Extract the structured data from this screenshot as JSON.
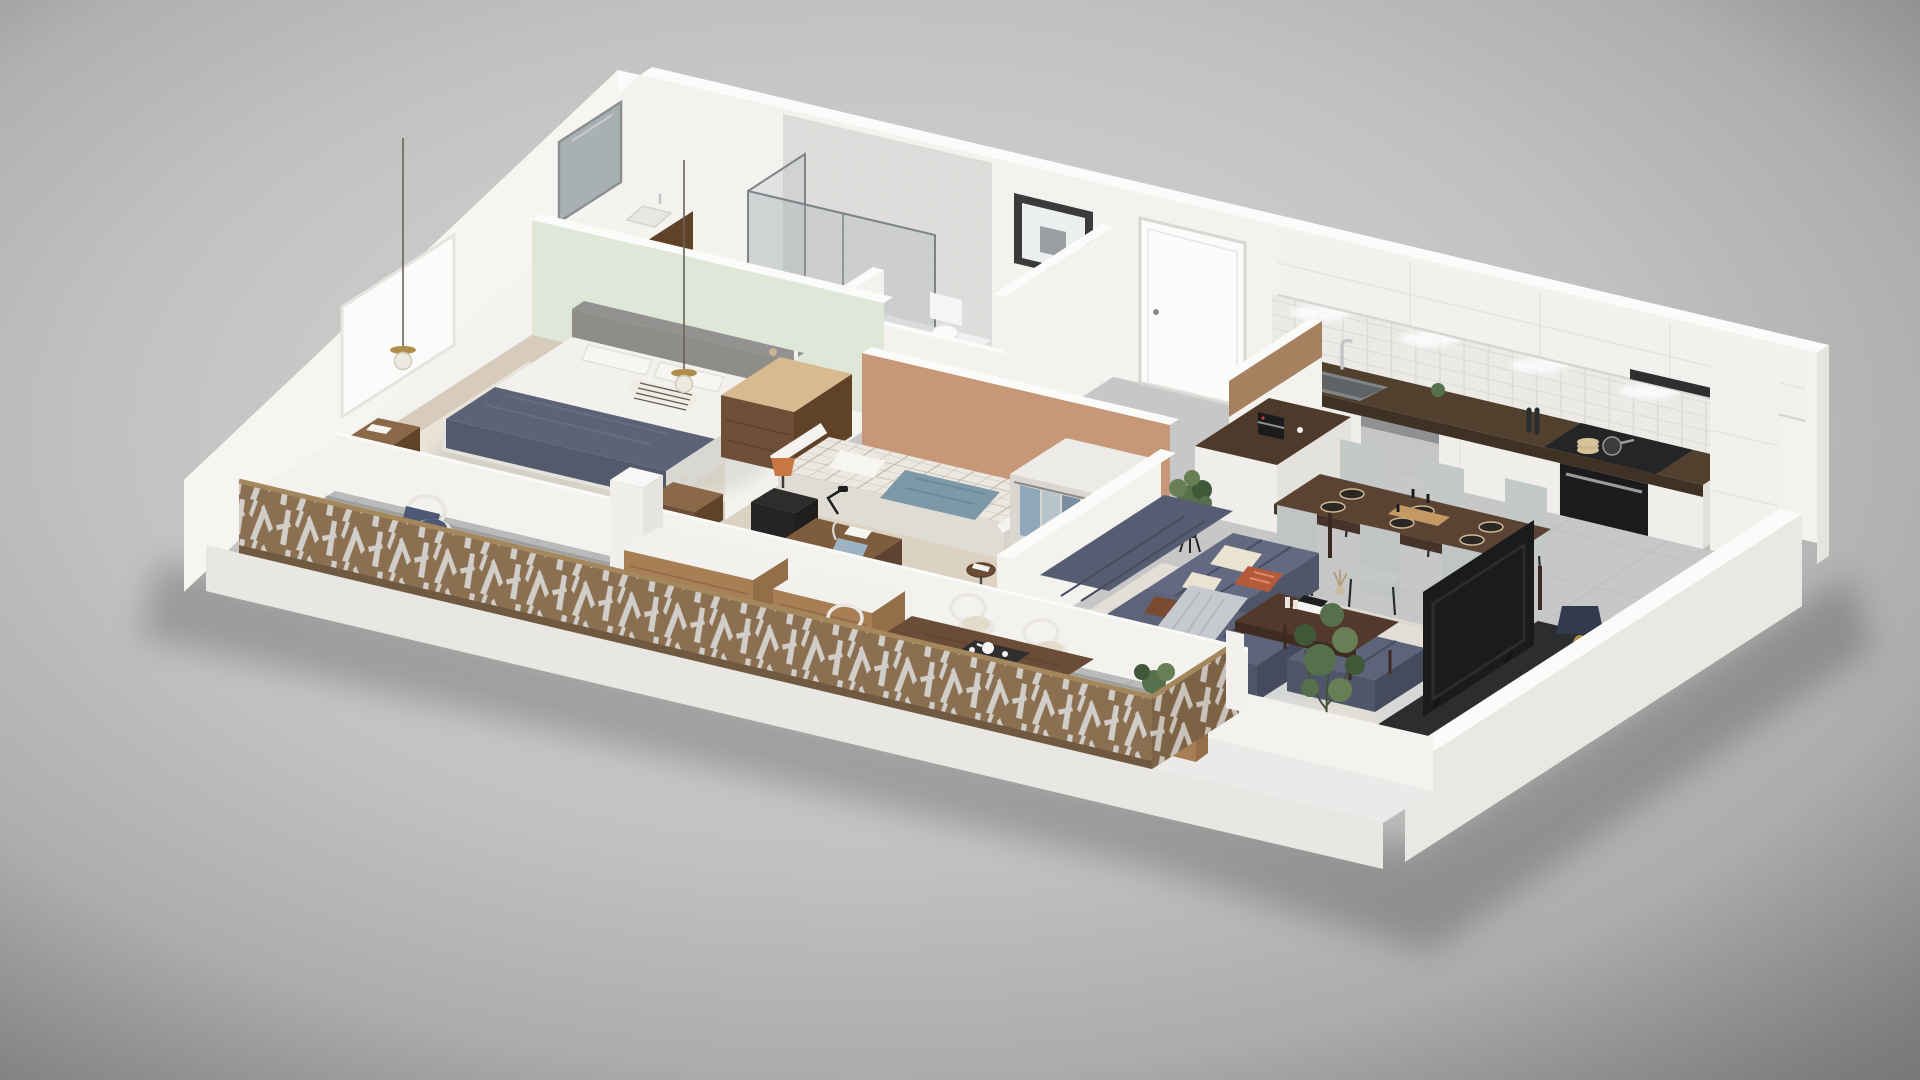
{
  "scene": {
    "title": "3D isometric cutaway floor plan of a furnished one-bedroom-plus apartment with balcony",
    "view": "aerial dollhouse cutaway, walls sliced low toward the viewer",
    "background": {
      "center": "#dadad9",
      "edge": "#989897"
    }
  },
  "palette": {
    "bg_center": "#dadad9",
    "bg_mid": "#c2c2c1",
    "bg_edge": "#989897",
    "wall_white": "#f3f2ef",
    "wall_top": "#fbfbf9",
    "wall_shade": "#e6e4e0",
    "wall_outer": "#f6f5f2",
    "wall_dark": "#d7d5d1",
    "slab_front": "#e9e7e3",
    "slab_right": "#d8d6d2",
    "ledge": "#eceae8",
    "green_wall": "#dfe7d8",
    "terracotta": "#c69878",
    "floor_gray": "#c6c7c6",
    "floor_line": "#b7b8b7",
    "floor_beige": "#d7ccbc",
    "rug_cream": "#eae4d8",
    "floor_b2": "#dcd2c2",
    "balcony_floor": "#b9bab9",
    "balcony_line": "#a7a8a7",
    "rug_living": "#e4dfd6",
    "rug_blotch_blue": "#cdd3d7",
    "rug_blotch_tan": "#d9cbbc",
    "counter_dark": "#52402f",
    "counter_edge": "#3f3124",
    "cabinet_face": "#efeeea",
    "cabinet_upper": "#f2f1ee",
    "backsplash": "#eceae7",
    "tile_line": "#dcdad6",
    "tile_wall": "#dedddb",
    "oven_black": "#1b1b1d",
    "steel": "#c3c5c6",
    "steel_dark": "#8e9092",
    "cooktop": "#242527",
    "island_top": "#4e3a2b",
    "table_wood": "#5b4334",
    "table_apron": "#46332a",
    "coffee_table": "#52392b",
    "wood_leg": "#3a2a22",
    "chair_gray": "#c3c9c7",
    "chair_gray_dark": "#bfc5c3",
    "chair_leg": "#2c2c2c",
    "plate_dark": "#2b2724",
    "plate_ring": "#cfb995",
    "runner_board": "#c49a62",
    "sofa": "#565d72",
    "sofa_seat": "#626980",
    "sofa_front": "#4f5669",
    "sofa_dark": "#454b5d",
    "sofa_corner": "#5d6479",
    "sofa_seam": "#474d5f",
    "pillow_cream": "#eae3d1",
    "pillow_rust": "#b45a3a",
    "pillow_rust_lt": "#d98c6a",
    "pillow_brown": "#7a4a32",
    "throw_gray": "#c6c9ce",
    "throw_gray_dk": "#bcbfc5",
    "bed_white": "#f2f1ed",
    "bed_side": "#e4e2dd",
    "bed_right": "#d9d7d2",
    "headboard": "#8f8d88",
    "headboard_top": "#949290",
    "runner_navy": "#5c6376",
    "runner_navy_dark": "#525a6c",
    "runner_fold": "#6a7186",
    "wood_mid": "#8a6848",
    "wood_dark": "#6e4e36",
    "wood_deep": "#604228",
    "dresser_top": "#d9ba90",
    "plaid_base": "#ebe8e1",
    "plaid_line": "#b9b2a2",
    "throw_blue": "#7d99a8",
    "throw_blue_dk": "#6d8a99",
    "bed2_side": "#dfdcd4",
    "bed2_right": "#d6d3cb",
    "tan_chair": "#bd8758",
    "tan_chair_light": "#d09c6c",
    "tan_pillow": "#8a5a3b",
    "lamp_orange": "#c87743",
    "nightstand_black": "#2e2d2c",
    "nightstand_black2": "#252423",
    "nightstand_black3": "#1f1e1d",
    "mirror": "#a9b0b2",
    "mirror_frame": "#8a9092",
    "glass_edge": "#7d8488",
    "towel_mint": "#cfe6da",
    "towel_mint2": "#b9d9c9",
    "door_white": "#fbfbfa",
    "frame_gray": "#d8d6d2",
    "handle_gray": "#8a8a88",
    "picture_frame": "#3a3a3a",
    "picture_mat": "#eceff0",
    "coat_wood": "#9c7450",
    "coat_wood_line": "#84603f",
    "jacket_navy": "#3d4452",
    "jacket_blue": "#9db3c4",
    "bag_brown": "#8a5c3c",
    "rod_gray": "#7a7a78",
    "railing": "#8a6f50",
    "railing_dark": "#7c6345",
    "railing_cap": "#a5875e",
    "railing_base": "#6f5940",
    "railing_cut": "#d5d3cf",
    "wicker": "#e9e7e0",
    "wicker_leg": "#d8d6cf",
    "cushion_navy": "#4d5874",
    "cushion_cream": "#e3dccb",
    "outdoor_table": "#6b4c38",
    "outdoor_leg": "#5a3f2c",
    "deck_wood": "#a87e54",
    "deck_wood_dark": "#946e48",
    "round_table": "#dcba85",
    "round_table_edge": "#c09d66",
    "plant_green": "#55704a",
    "plant_green_light": "#677f55",
    "plant_dark": "#3f5838",
    "pot_black": "#26272a",
    "tv_black": "#1a1b1d",
    "tv_inner": "#2a2c2e",
    "console_dark": "#2c2d2f",
    "console_end": "#232426",
    "lamp_navy": "#323a4e",
    "brass": "#b08d4a",
    "cord": "#6a6258",
    "track": "#9e9e9c",
    "mat_gray": "#a7a8a7",
    "wire_black": "#1c1c1c",
    "shadow_ink": "#000000"
  },
  "rooms": {
    "master_bedroom": {
      "label": "Master bedroom",
      "items": [
        "double bed with white duvet",
        "navy throw runner",
        "striped accent pillow",
        "gray upholstered headboard",
        "two walnut nightstands",
        "curved walnut dresser",
        "two brass pendant lights",
        "cream area rug",
        "sage green accent wall",
        "white pouf"
      ]
    },
    "ensuite_bathroom": {
      "label": "En-suite bathroom",
      "items": [
        "walk-in glass shower",
        "wall mirror",
        "walnut vanity with white basin",
        "mint green towels",
        "gray tiled wall"
      ]
    },
    "wc": {
      "label": "Guest WC",
      "items": [
        "wall-hung toilet",
        "framed artwork"
      ]
    },
    "entry": {
      "label": "Entry hall",
      "items": [
        "white entrance door",
        "open coat rack with hanging jackets",
        "leather bag",
        "wood half-wall screen"
      ]
    },
    "bedroom_2": {
      "label": "Second bedroom",
      "items": [
        "single bed with checked bedding",
        "steel-blue throw",
        "black nightstand with orange lamp",
        "tan curved armchair",
        "round side table with books",
        "wooden desk with black task lamp",
        "desk chair with blue cushion",
        "open wardrobe with clothes",
        "terracotta accent wall"
      ]
    },
    "kitchen": {
      "label": "Kitchen",
      "items": [
        "white upper and lower cabinets",
        "dark walnut countertop",
        "double sink with chrome faucet",
        "stainless dishwasher",
        "built-in black oven",
        "cooktop with pan",
        "subway tile backsplash",
        "under-cabinet lighting",
        "white island with espresso machine",
        "potted plant on tripod stand",
        "tall cabinet column"
      ]
    },
    "dining": {
      "label": "Dining area",
      "items": [
        "walnut dining table",
        "six pale gray upholstered chairs",
        "dark place settings",
        "candles",
        "serving board"
      ]
    },
    "living": {
      "label": "Living room",
      "items": [
        "navy modular tufted sofa",
        "cream and rust cushions",
        "gray knit throw",
        "walnut coffee table with books and vase",
        "abstract cream rug",
        "TV on dark media bench",
        "navy table lamp with brass base",
        "fiddle-leaf fig plant",
        "white vases"
      ]
    },
    "balcony": {
      "label": "Balcony terrace",
      "items": [
        "bronze laser-cut privacy railing",
        "two white wicker armchairs with navy cushions",
        "round oak coffee table with espresso cups",
        "timber storage benches",
        "outdoor dining table with tea tray",
        "wicker dining chairs",
        "black wire lantern",
        "white planter with shrub",
        "timber planter",
        "gray floor tiles"
      ]
    }
  }
}
